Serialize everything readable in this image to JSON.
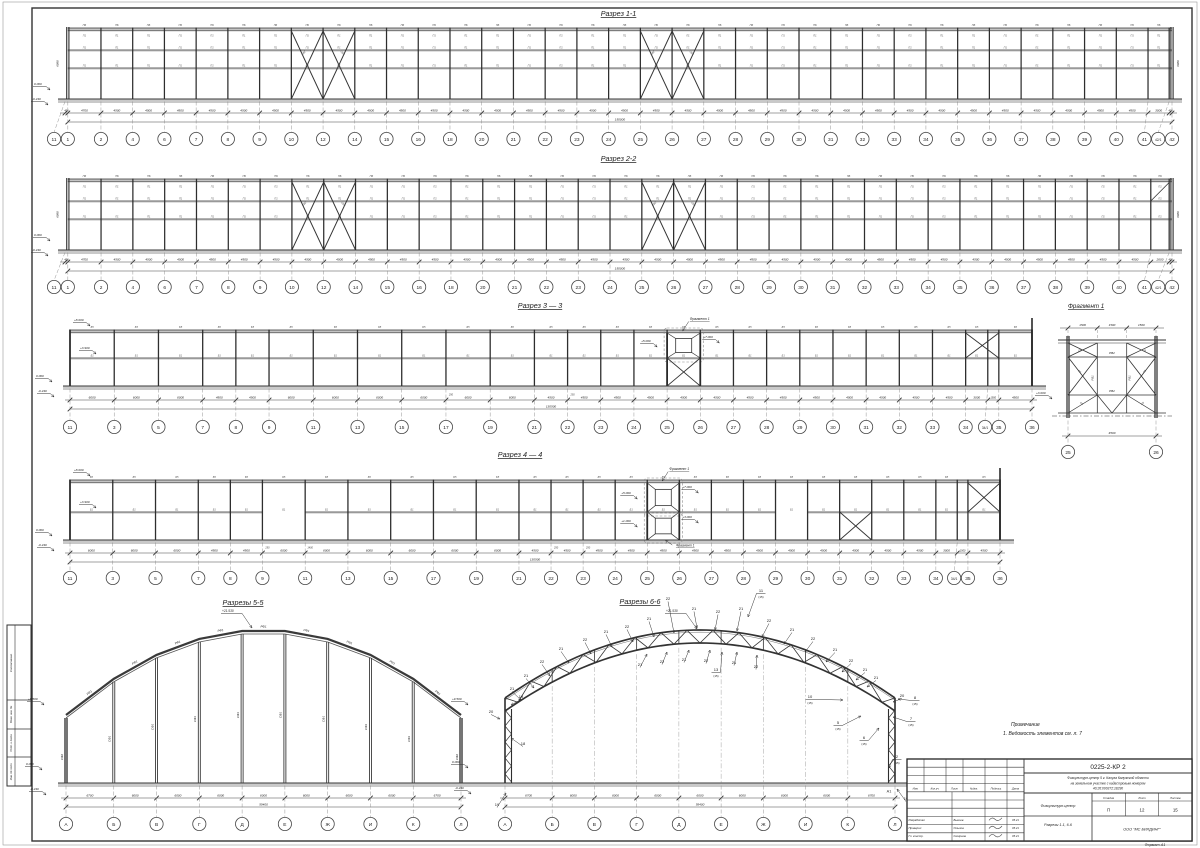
{
  "frame": {
    "format_note": "Формат А1",
    "side_labels": [
      "Согласовано",
      "Взам. инв. №",
      "Подп. и дата",
      "Инв. № подл."
    ]
  },
  "sections": {
    "s11": {
      "title": "Разрез 1-1",
      "axes": [
        "11",
        "1",
        "2",
        "4",
        "6",
        "7",
        "8",
        "9",
        "10",
        "12",
        "14",
        "15",
        "16",
        "18",
        "20",
        "21",
        "22",
        "23",
        "24",
        "25",
        "26",
        "27",
        "28",
        "29",
        "30",
        "31",
        "32",
        "33",
        "34",
        "35",
        "36",
        "37",
        "38",
        "39",
        "40",
        "41",
        "42/1",
        "42"
      ],
      "dims": [
        "400",
        "4700",
        "4500",
        "4500",
        "4500",
        "4500",
        "4500",
        "4500",
        "4500",
        "4500",
        "4500",
        "4500",
        "4500",
        "4500",
        "4500",
        "4500",
        "4500",
        "4500",
        "4500",
        "4500",
        "4500",
        "4500",
        "4500",
        "4500",
        "4500",
        "4500",
        "4500",
        "4500",
        "4500",
        "4500",
        "4500",
        "4500",
        "4500",
        "4500",
        "4500",
        "3000",
        "400"
      ],
      "total": "150000",
      "vdim": "6080",
      "panel_top": "ПБ",
      "panel": "П1",
      "brace_labels": [
        "СВ2",
        "СВ3"
      ],
      "elev_zero": "0.000",
      "elev_base": "-0.240"
    },
    "s22": {
      "title": "Разрез 2-2",
      "axes": [
        "11",
        "1",
        "2",
        "4",
        "6",
        "7",
        "8",
        "9",
        "10",
        "12",
        "14",
        "15",
        "16",
        "18",
        "20",
        "21",
        "22",
        "23",
        "24",
        "25",
        "26",
        "27",
        "28",
        "29",
        "30",
        "31",
        "32",
        "33",
        "34",
        "35",
        "36",
        "37",
        "38",
        "39",
        "40",
        "41",
        "42/1",
        "42"
      ],
      "dims": [
        "400",
        "4700",
        "4500",
        "4500",
        "4500",
        "4500",
        "4500",
        "4500",
        "4500",
        "4500",
        "4500",
        "4500",
        "4500",
        "4500",
        "4500",
        "4500",
        "4500",
        "4500",
        "4500",
        "4500",
        "4500",
        "4500",
        "4500",
        "4500",
        "4500",
        "4500",
        "4500",
        "4500",
        "4500",
        "4500",
        "4500",
        "4500",
        "4500",
        "4500",
        "4500",
        "2600",
        "400"
      ],
      "total": "150000",
      "vdim": "6080",
      "panel_top": "ПБ",
      "panel": "П1",
      "brace_labels": [
        "СВ2",
        "СВ3"
      ],
      "elev_zero": "0.000",
      "elev_base": "-0.240"
    },
    "s33": {
      "title": "Разрез 3 — 3",
      "axes": [
        "11",
        "3",
        "5",
        "7",
        "8",
        "9",
        "11",
        "13",
        "15",
        "17",
        "19",
        "21",
        "22",
        "23",
        "24",
        "25",
        "26",
        "27",
        "28",
        "29",
        "30",
        "31",
        "32",
        "33",
        "34",
        "34/1",
        "35",
        "36"
      ],
      "dims": [
        "6000",
        "6000",
        "6000",
        "4500",
        "4500",
        "6000",
        "6000",
        "6000",
        "6000",
        "6000",
        "6000",
        "4500",
        "4500",
        "4500",
        "4500",
        "4500",
        "4500",
        "4500",
        "4500",
        "4500",
        "4500",
        "4500",
        "4500",
        "4500",
        "3000",
        "1500",
        "4500"
      ],
      "total": "130500",
      "panel_top": "Б5",
      "panel": "Б1",
      "elev": [
        "+8.000",
        "+3.900",
        "0.000",
        "-0.240"
      ],
      "frag_marks": [
        "+5.000",
        "+7.000"
      ],
      "right_mark": "+3.000",
      "fragment_label": "Фрагмент 1",
      "extra_dims": [
        {
          "t": "250",
          "i": 9
        },
        {
          "t": "250",
          "i": 12
        }
      ]
    },
    "s44": {
      "title": "Разрез 4 — 4",
      "axes": [
        "11",
        "3",
        "5",
        "7",
        "8",
        "9",
        "11",
        "13",
        "15",
        "17",
        "19",
        "21",
        "22",
        "23",
        "24",
        "25",
        "26",
        "27",
        "28",
        "29",
        "30",
        "31",
        "32",
        "33",
        "34",
        "34/1",
        "35",
        "36"
      ],
      "dims": [
        "6000",
        "6000",
        "6000",
        "4500",
        "4500",
        "6000",
        "6000",
        "6000",
        "6000",
        "6000",
        "6000",
        "4500",
        "4500",
        "4500",
        "4500",
        "4500",
        "4500",
        "4500",
        "4500",
        "4500",
        "4500",
        "4500",
        "4500",
        "4500",
        "3000",
        "1500",
        "4500"
      ],
      "total": "130500",
      "panel_top": "Б5",
      "panel": "Б1",
      "elev": [
        "+8.000",
        "+3.900",
        "0.000",
        "-0.240"
      ],
      "frag_marks_up": [
        "+5.000",
        "+7.000"
      ],
      "frag_marks_lo": [
        "+1.000",
        "+3.000"
      ],
      "fragment_label": "Фрагмент 1",
      "extra_dims": [
        {
          "t": "250",
          "i": 5
        },
        {
          "t": "1400",
          "i": 6
        },
        {
          "t": "250",
          "i": 12
        },
        {
          "t": "250",
          "i": 13
        }
      ]
    },
    "s55": {
      "title": "Разрезы 5-5",
      "axes": [
        "А",
        "Б",
        "В",
        "Г",
        "Д",
        "Е",
        "Ж",
        "И",
        "К",
        "Л"
      ],
      "dims": [
        "6700",
        "6000",
        "6000",
        "6000",
        "6000",
        "6000",
        "6000",
        "6000",
        "6700"
      ],
      "total": "55400",
      "arch_label": "РФ1",
      "col_label": "СФ1",
      "end_col_label": "СФ2",
      "peak": "+21.530",
      "spring": "+9.500",
      "zero": "0.000",
      "base": "-0.240"
    },
    "s66": {
      "title": "Разрезы 6-6",
      "axes": [
        "А",
        "Б",
        "В",
        "Г",
        "Д",
        "Е",
        "Ж",
        "И",
        "К",
        "Л"
      ],
      "dims": [
        "6700",
        "6000",
        "6000",
        "6000",
        "6000",
        "6000",
        "6000",
        "6000",
        "6700"
      ],
      "total": "55400",
      "peak": "+21.530",
      "spring": "+9.500",
      "zero": "0.000",
      "base": "-0.240",
      "anchor": "А1",
      "ref_suffix": "(15)",
      "callouts": [
        {
          "t": "21",
          "x": 512,
          "y": 690,
          "tx": 521,
          "ty": 700
        },
        {
          "t": "21",
          "x": 526,
          "y": 677,
          "tx": 534,
          "ty": 688
        },
        {
          "t": "22",
          "x": 542,
          "y": 663,
          "tx": 550,
          "ty": 676
        },
        {
          "t": "21",
          "x": 561,
          "y": 650,
          "tx": 569,
          "ty": 663
        },
        {
          "t": "22",
          "x": 585,
          "y": 641,
          "tx": 591,
          "ty": 654
        },
        {
          "t": "21",
          "x": 606,
          "y": 633,
          "tx": 612,
          "ty": 647
        },
        {
          "t": "22",
          "x": 627,
          "y": 628,
          "tx": 633,
          "ty": 642
        },
        {
          "t": "21",
          "x": 649,
          "y": 620,
          "tx": 654,
          "ty": 637
        },
        {
          "t": "22",
          "x": 668,
          "y": 600,
          "tx": 674,
          "ty": 633
        },
        {
          "t": "21",
          "x": 694,
          "y": 610,
          "tx": 697,
          "ty": 628
        },
        {
          "t": "22",
          "x": 718,
          "y": 613,
          "tx": 715,
          "ty": 630
        },
        {
          "t": "21",
          "x": 741,
          "y": 610,
          "tx": 737,
          "ty": 631
        },
        {
          "t": "22",
          "x": 769,
          "y": 622,
          "tx": 762,
          "ty": 637
        },
        {
          "t": "21",
          "x": 792,
          "y": 631,
          "tx": 784,
          "ty": 644
        },
        {
          "t": "22",
          "x": 813,
          "y": 640,
          "tx": 805,
          "ty": 652
        },
        {
          "t": "21",
          "x": 835,
          "y": 651,
          "tx": 826,
          "ty": 662
        },
        {
          "t": "22",
          "x": 851,
          "y": 662,
          "tx": 842,
          "ty": 672
        },
        {
          "t": "21",
          "x": 865,
          "y": 671,
          "tx": 856,
          "ty": 680
        },
        {
          "t": "21",
          "x": 876,
          "y": 679,
          "tx": 867,
          "ty": 687
        },
        {
          "t": "21",
          "x": 640,
          "y": 666,
          "tx": 647,
          "ty": 654
        },
        {
          "t": "22",
          "x": 662,
          "y": 663,
          "tx": 667,
          "ty": 652
        },
        {
          "t": "21",
          "x": 684,
          "y": 661,
          "tx": 689,
          "ty": 650
        },
        {
          "t": "22",
          "x": 706,
          "y": 662,
          "tx": 710,
          "ty": 650
        },
        {
          "t": "21",
          "x": 734,
          "y": 664,
          "tx": 737,
          "ty": 652
        },
        {
          "t": "22",
          "x": 756,
          "y": 668,
          "tx": 757,
          "ty": 655
        },
        {
          "t": "19",
          "x": 521,
          "y": 698,
          "tx": 511,
          "ty": 705
        },
        {
          "t": "18",
          "x": 523,
          "y": 745,
          "tx": 511,
          "ty": 738
        },
        {
          "t": "20",
          "x": 491,
          "y": 713,
          "tx": 500,
          "ty": 719
        },
        {
          "t": "20",
          "x": 902,
          "y": 697,
          "tx": 893,
          "ty": 702
        },
        {
          "t": "11",
          "r": 1,
          "x": 761,
          "y": 592,
          "tx": 748,
          "ty": 617
        },
        {
          "t": "13",
          "r": 1,
          "x": 716,
          "y": 671,
          "tx": 722,
          "ty": 652
        },
        {
          "t": "10",
          "r": 1,
          "x": 810,
          "y": 698,
          "tx": 843,
          "ty": 700
        },
        {
          "t": "5",
          "r": 1,
          "x": 838,
          "y": 724,
          "tx": 861,
          "ty": 716
        },
        {
          "t": "6",
          "r": 1,
          "x": 864,
          "y": 739,
          "tx": 879,
          "ty": 728
        },
        {
          "t": "7",
          "r": 1,
          "x": 911,
          "y": 720,
          "tx": 893,
          "ty": 717
        },
        {
          "t": "8",
          "r": 1,
          "x": 915,
          "y": 699,
          "tx": 898,
          "ty": 699
        },
        {
          "t": "2",
          "r": 1,
          "x": 897,
          "y": 758,
          "tx": 889,
          "ty": 768
        },
        {
          "t": "19",
          "x": 497,
          "y": 806,
          "tx": 506,
          "ty": 793
        },
        {
          "t": "19",
          "x": 906,
          "y": 800,
          "tx": 897,
          "ty": 789
        }
      ]
    }
  },
  "fragment1": {
    "title": "Фрагмент 1",
    "dims_top": [
      "1500",
      "1500",
      "1500"
    ],
    "dim_bottom": "4500",
    "axes": [
      "25",
      "26"
    ],
    "beam_label": "РВ2",
    "post_label": "РВ1",
    "brace_label": "СВ"
  },
  "note": {
    "title": "Примечание",
    "line": "1. Ведомость элементов    см. л. 7"
  },
  "titleblock": {
    "doc_number": "0225-2-КР 2",
    "description": [
      "Физкультурн-центр 5 г. Калуга Калужской области",
      "на земельном участке с кадастровым номером",
      "40:26:000372:18290"
    ],
    "object": "Физкультурн-центр",
    "sheet_title": "Разрезы 1-1, 6-6",
    "columns": [
      "Изм.",
      "Кол.уч.",
      "Лист",
      "№док.",
      "Подпись",
      "Дата"
    ],
    "staff": [
      {
        "role": "Разработал",
        "name": "Бышев",
        "date": "05.21"
      },
      {
        "role": "Проверил",
        "name": "Ольхов",
        "date": "05.21"
      },
      {
        "role": "Гл. констр.",
        "name": "Смирнов",
        "date": "05.21"
      }
    ],
    "stage_cols": [
      "Стадия",
      "Лист",
      "Листов"
    ],
    "stage_vals": [
      "П",
      "12",
      "15"
    ],
    "company": "ООО \"МС БИЛДИНГ\""
  }
}
